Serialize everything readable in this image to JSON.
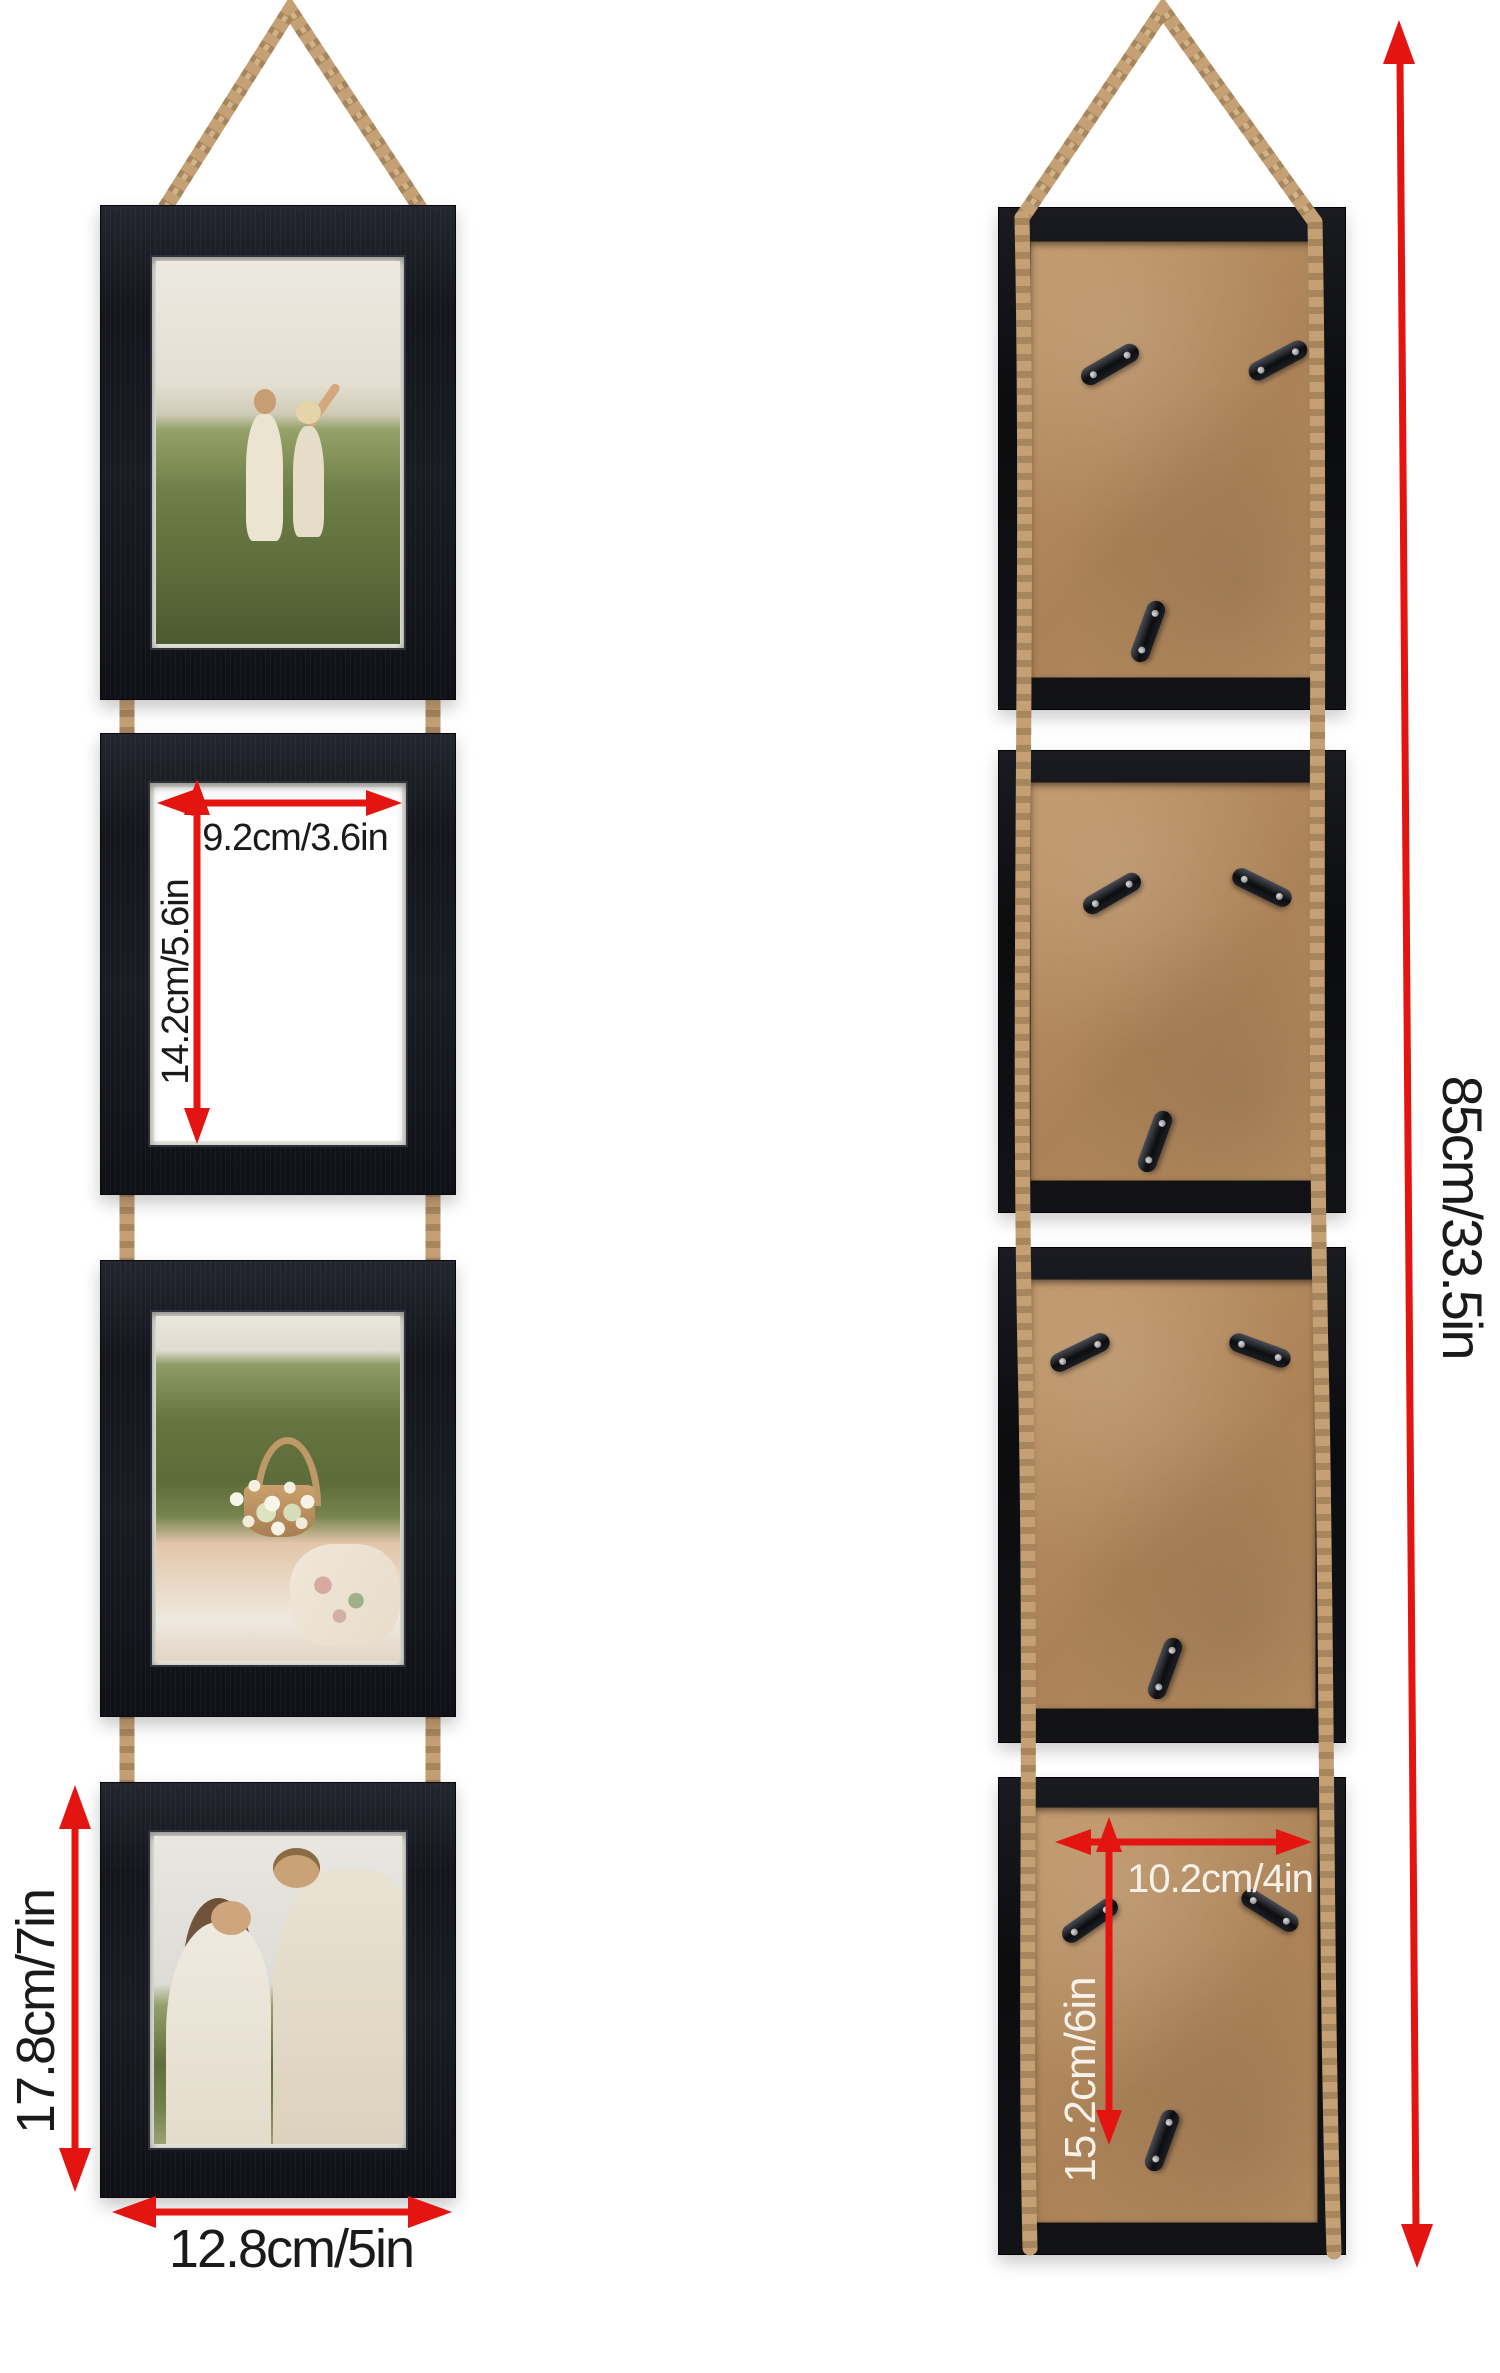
{
  "description": "Dimension diagram of a 4-frame vertical hanging picture frame set, front view (left) and back view (right)",
  "colors": {
    "background": "#ffffff",
    "arrow_red": "#e41410",
    "frame_black": "#16181e",
    "backing_tan": "#b88e61",
    "rope_tan": "#c4a074",
    "label_dark": "#1a1a1a",
    "label_light": "#f6f2e9"
  },
  "dimensions": {
    "photo_opening_width": "9.2cm/3.6in",
    "photo_opening_height": "14.2cm/5.6in",
    "frame_height": "17.8cm/7in",
    "frame_width": "12.8cm/5in",
    "total_hanging_height": "85cm/33.5in",
    "back_opening_width": "10.2cm/4in",
    "back_opening_height": "15.2cm/6in"
  },
  "front_view": {
    "frames": [
      {
        "position": "top",
        "content": "photo of a couple walking in a grassy field"
      },
      {
        "position": "second",
        "content": "empty white opening with width and height arrows"
      },
      {
        "position": "third",
        "content": "photo of a flower basket on a picnic blanket"
      },
      {
        "position": "bottom",
        "content": "photo of a couple embracing in a field"
      }
    ],
    "hanger": "jute rope"
  },
  "back_view": {
    "frames": [
      {
        "position": "top",
        "hardware": "3 metal mounting clips on cardboard backing"
      },
      {
        "position": "second",
        "hardware": "3 metal mounting clips on cardboard backing"
      },
      {
        "position": "third",
        "hardware": "3 metal mounting clips on cardboard backing"
      },
      {
        "position": "bottom",
        "hardware": "3 metal mounting clips, opening dimensions shown"
      }
    ],
    "hanger": "jute rope"
  }
}
